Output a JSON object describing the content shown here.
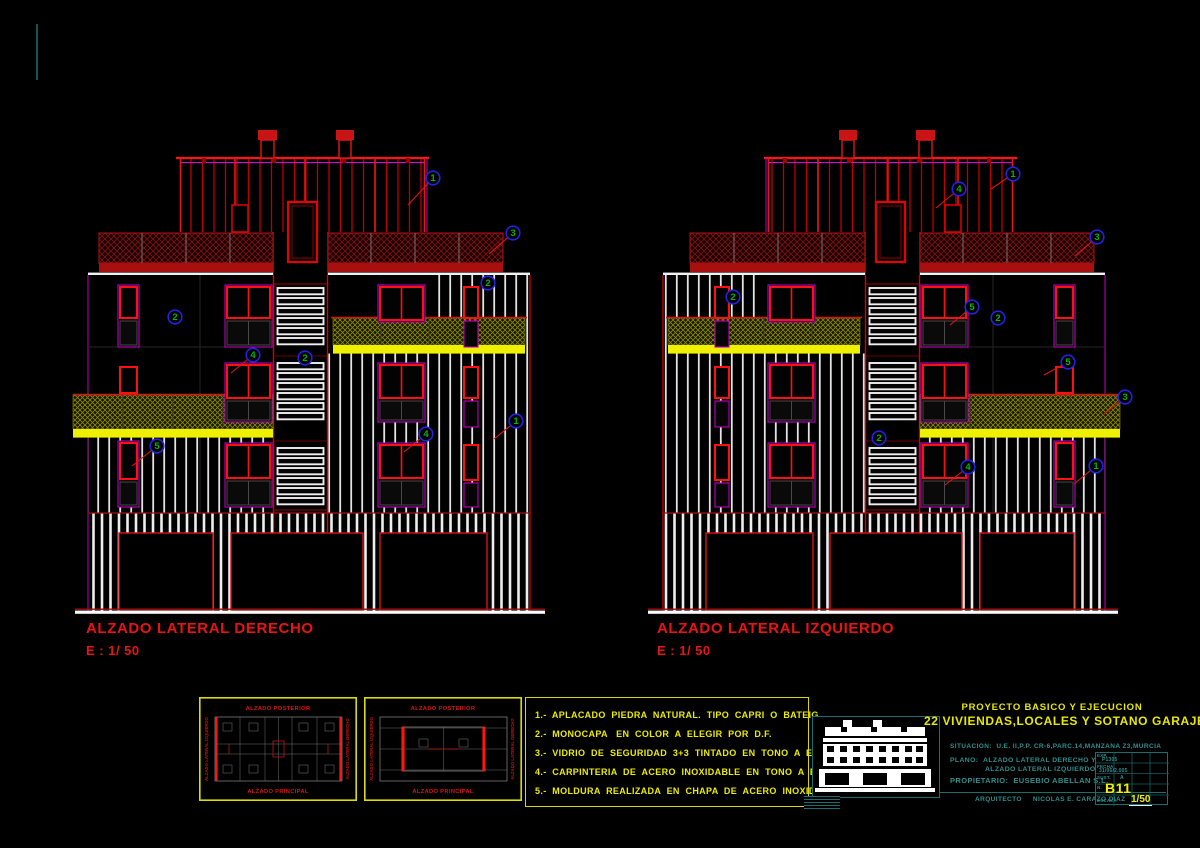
{
  "sheet": {
    "bg": "#000000",
    "colors": {
      "red": "#FF0000",
      "dark_red": "#8B0000",
      "magenta": "#BE00BE",
      "yellow": "#FFFF00",
      "olive_hatch": "#8A8A00",
      "white": "#FFFFFF",
      "teal": "#2E8F8F",
      "callout_blue": "#2222E0",
      "callout_green": "#00B414"
    }
  },
  "elevations": [
    {
      "id": "derecho",
      "title": "ALZADO LATERAL DERECHO",
      "scale": "E : 1/ 50",
      "mirror": false,
      "callouts": [
        {
          "n": "1",
          "cx": 358,
          "cy": 53,
          "lx": 333,
          "ly": 80
        },
        {
          "n": "3",
          "cx": 438,
          "cy": 108,
          "lx": 414,
          "ly": 129
        },
        {
          "n": "2",
          "cx": 413,
          "cy": 158
        },
        {
          "n": "2",
          "cx": 100,
          "cy": 192
        },
        {
          "n": "4",
          "cx": 178,
          "cy": 230,
          "lx": 156,
          "ly": 248
        },
        {
          "n": "2",
          "cx": 230,
          "cy": 233
        },
        {
          "n": "5",
          "cx": 82,
          "cy": 321,
          "lx": 57,
          "ly": 341
        },
        {
          "n": "4",
          "cx": 351,
          "cy": 309,
          "lx": 329,
          "ly": 327
        },
        {
          "n": "1",
          "cx": 441,
          "cy": 296,
          "lx": 419,
          "ly": 314
        }
      ]
    },
    {
      "id": "izquierdo",
      "title": "ALZADO LATERAL IZQUIERDO",
      "scale": "E : 1/ 50",
      "mirror": true,
      "callouts": [
        {
          "n": "1",
          "cx": 365,
          "cy": 49,
          "lx": 343,
          "ly": 64
        },
        {
          "n": "4",
          "cx": 311,
          "cy": 64,
          "lx": 288,
          "ly": 83
        },
        {
          "n": "3",
          "cx": 449,
          "cy": 112,
          "lx": 427,
          "ly": 131
        },
        {
          "n": "2",
          "cx": 85,
          "cy": 172
        },
        {
          "n": "5",
          "cx": 324,
          "cy": 182,
          "lx": 302,
          "ly": 200
        },
        {
          "n": "2",
          "cx": 350,
          "cy": 193
        },
        {
          "n": "5",
          "cx": 420,
          "cy": 237,
          "lx": 396,
          "ly": 250
        },
        {
          "n": "3",
          "cx": 477,
          "cy": 272,
          "lx": 455,
          "ly": 290
        },
        {
          "n": "2",
          "cx": 231,
          "cy": 313
        },
        {
          "n": "4",
          "cx": 320,
          "cy": 342,
          "lx": 297,
          "ly": 360
        },
        {
          "n": "1",
          "cx": 448,
          "cy": 341,
          "lx": 426,
          "ly": 359
        }
      ]
    }
  ],
  "keyplans": [
    {
      "top": "ALZADO POSTERIOR",
      "bottom": "ALZADO PRINCIPAL",
      "left": "ALZADO LATERAL IZQUIERDO",
      "right": "ALZADO LATERAL DERECHO",
      "variant": "floor"
    },
    {
      "top": "ALZADO POSTERIOR",
      "bottom": "ALZADO PRINCIPAL",
      "left": "ALZADO LATERAL IZQUIERDO",
      "right": "ALZADO LATERAL DERECHO",
      "variant": "roof"
    }
  ],
  "legend": {
    "items": [
      "1.-  APLACADO  PIEDRA  NATURAL.  TIPO  CAPRI  O  BATEIG.",
      "2.-  MONOCAPA   EN  COLOR  A  ELEGIR  POR  D.F.",
      "3.-  VIDRIO  DE  SEGURIDAD  3+3  TINTADO  EN  TONO  A  ELEGIR  POR  D.F.",
      "4.-  CARPINTERIA  DE  ACERO  INOXIDABLE  EN  TONO  A  ELEGIR  POR  D.F.",
      "5.-  MOLDURA  REALIZADA  EN  CHAPA  DE  ACERO  INOXIDABLE"
    ]
  },
  "titleblock": {
    "project_line1": "PROYECTO  BASICO  Y  EJECUCION",
    "project_line2": "22  VIVIENDAS,LOCALES  Y  SOTANO  GARAJE",
    "situacion_label": "SITUACION:",
    "situacion_value": "U.E.  II,P.P.  CR-6,PARC.14,MANZANA  Z3,MURCIA",
    "plano_label": "PLANO:",
    "plano_line1": "ALZADO  LATERAL  DERECHO  Y",
    "plano_line2": "ALZADO  LATERAL  IZQUIERDO",
    "propietario_label": "PROPIETARIO:",
    "propietario_value": "EUSEBIO  ABELLAN  S.L.",
    "arquitecto_label": "ARQUITECTO",
    "arquitecto_value": "NICOLAS  E.  CARAZO  DIAZ",
    "stamp": {
      "exp_label": "EXP.",
      "exp_value": "P1305",
      "fecha_label": "FECHA",
      "fecha_value": "31/06/2.005",
      "sust_label": "SUST.",
      "sust_value": "A",
      "num_label": "N.",
      "num_value": "B11",
      "escala_label": "ESCALA",
      "escala_value": "1/50"
    }
  }
}
